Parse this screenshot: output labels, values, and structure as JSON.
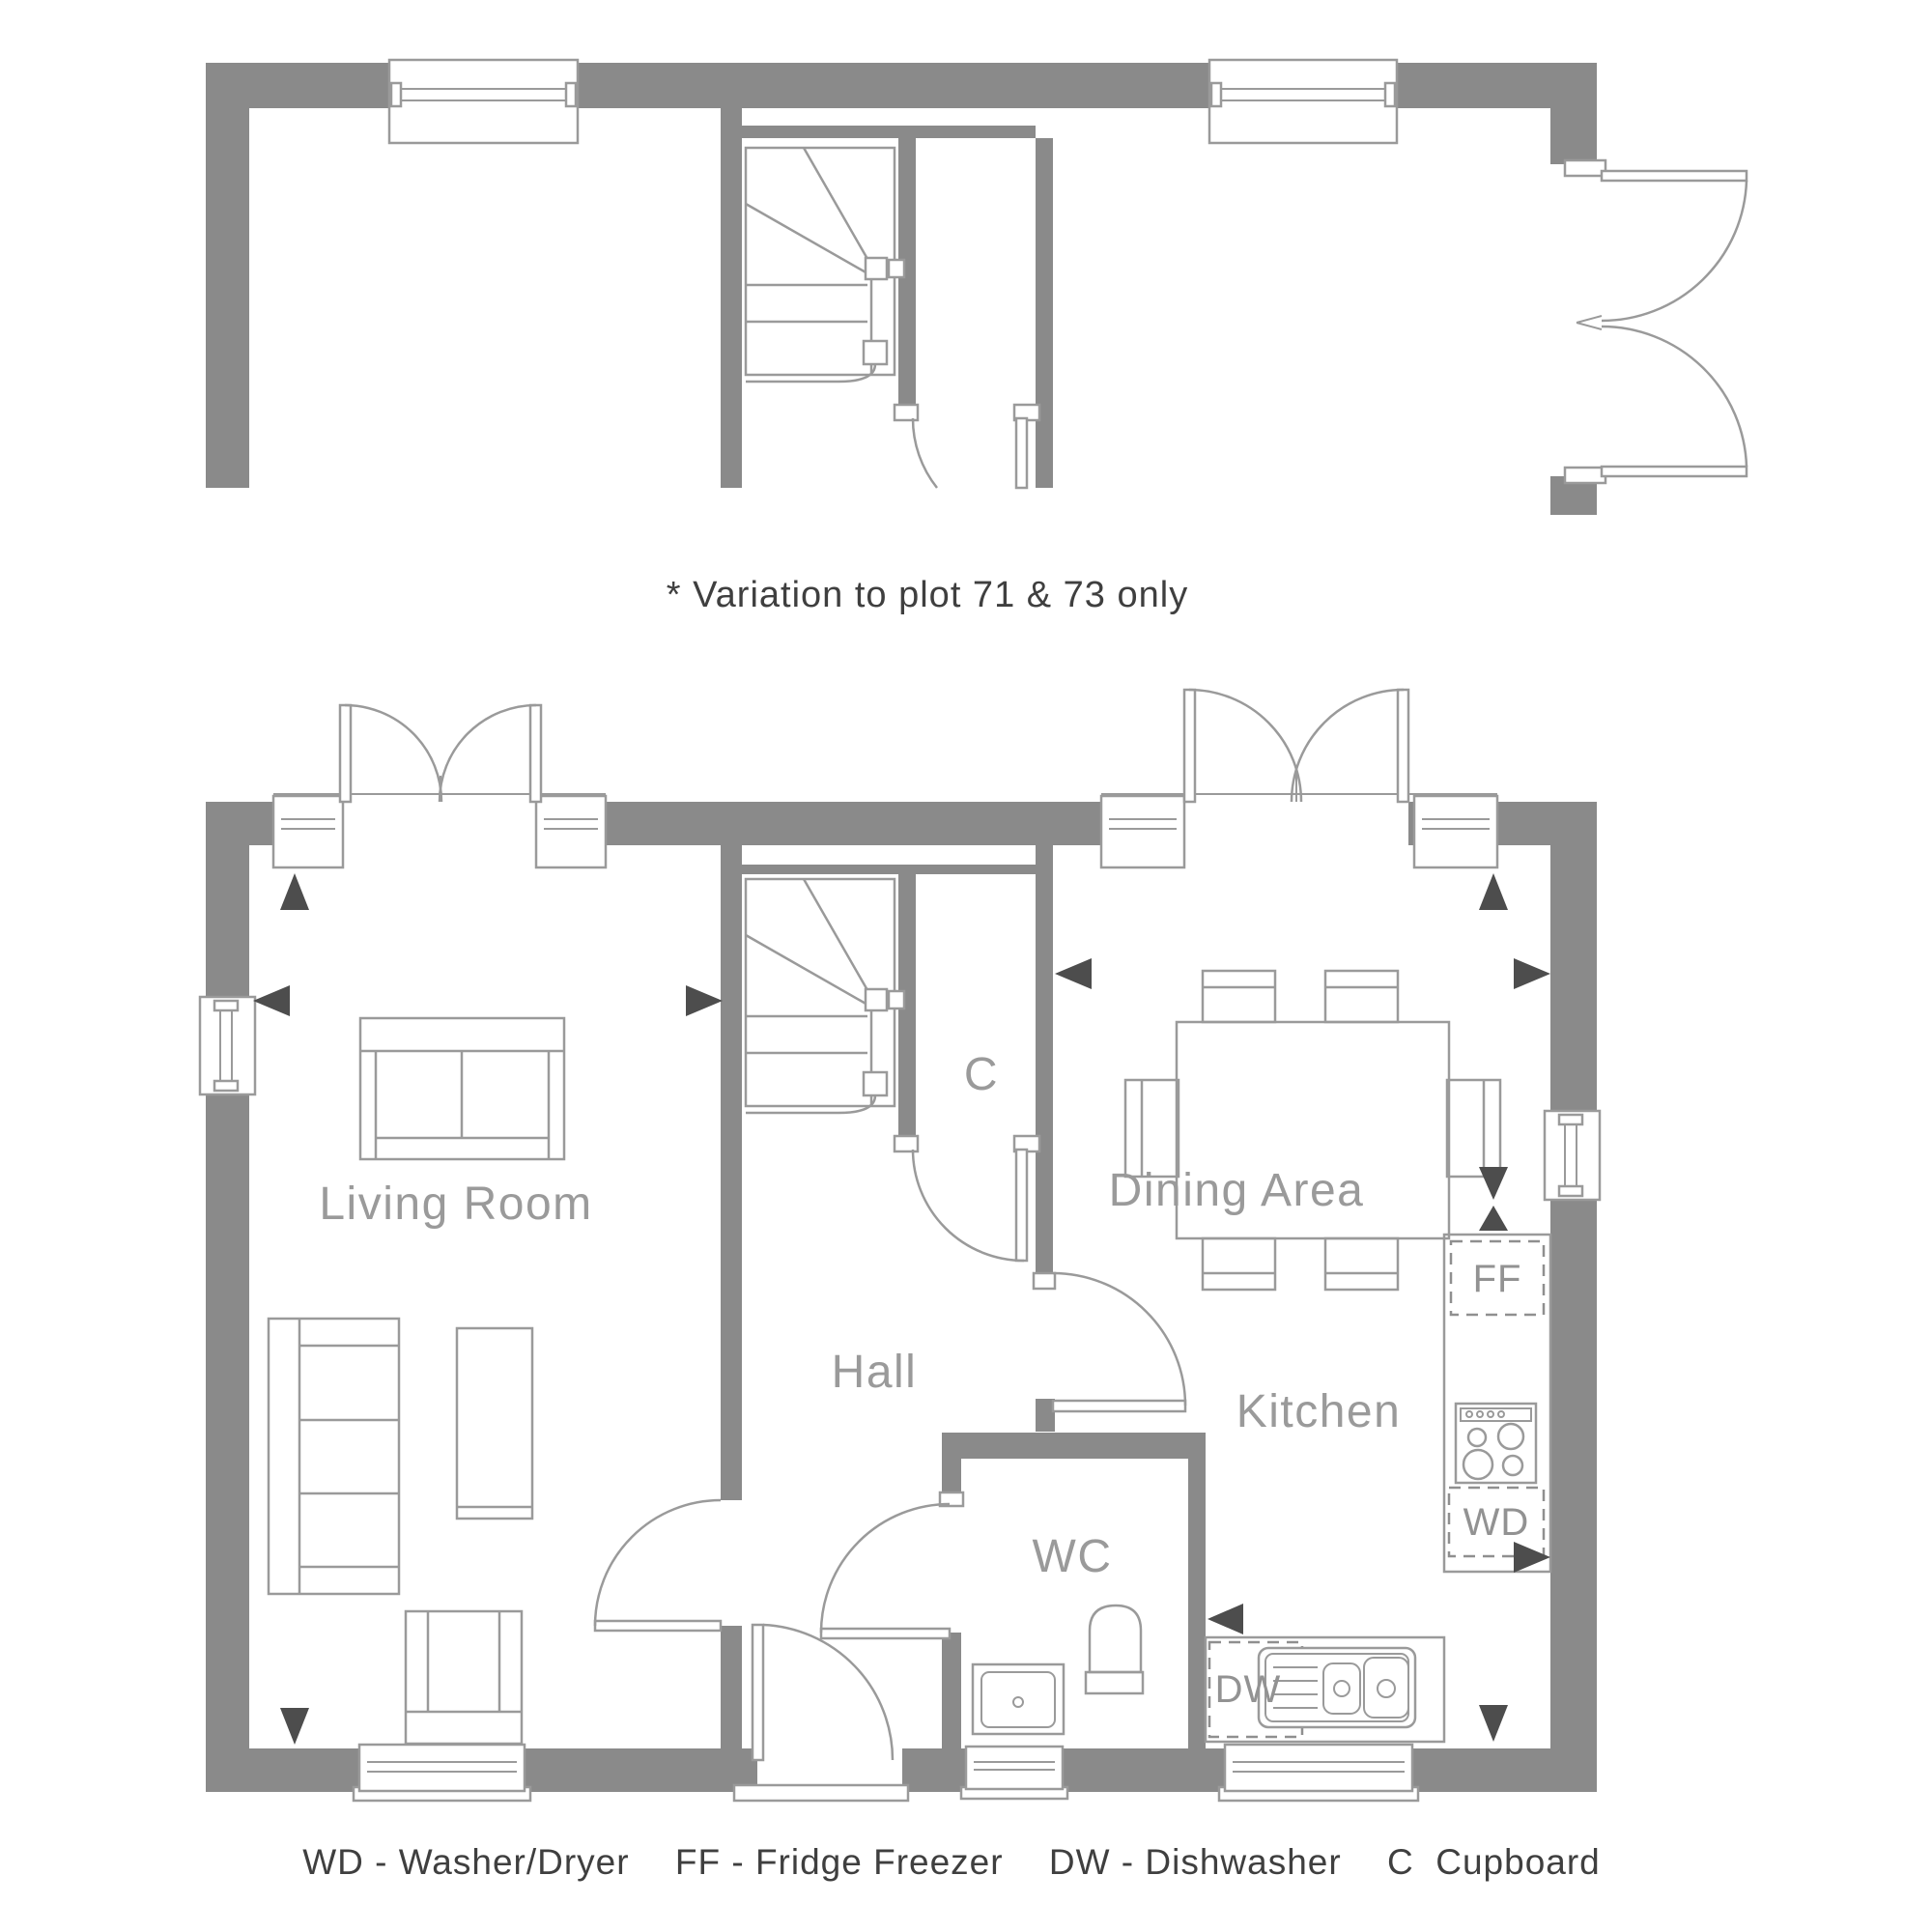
{
  "colors": {
    "wall_gray": "#8a8a8a",
    "line_gray": "#9a9a9a",
    "label_gray": "#9a9a9a",
    "dark_text": "#3f3f3f",
    "arrow_dark": "#4d4d4d",
    "background": "#ffffff"
  },
  "variation_note": "* Variation to plot 71 & 73 only",
  "rooms": {
    "living_room": "Living Room",
    "hall": "Hall",
    "cupboard": "C",
    "dining_area": "Dining Area",
    "kitchen": "Kitchen",
    "wc": "WC"
  },
  "appliances": {
    "fridge_freezer": "FF",
    "washer_dryer": "WD",
    "dishwasher": "DW"
  },
  "legend": {
    "full_text": "WD - Washer/Dryer   FF - Fridge Freezer   DW - Dishwasher   C  Cupboard",
    "entries": [
      {
        "abbr": "WD",
        "text": "WD - Washer/Dryer"
      },
      {
        "abbr": "FF",
        "text": "FF - Fridge Freezer"
      },
      {
        "abbr": "DW",
        "text": "DW - Dishwasher"
      },
      {
        "abbr": "C",
        "text": "C  Cupboard"
      }
    ]
  }
}
